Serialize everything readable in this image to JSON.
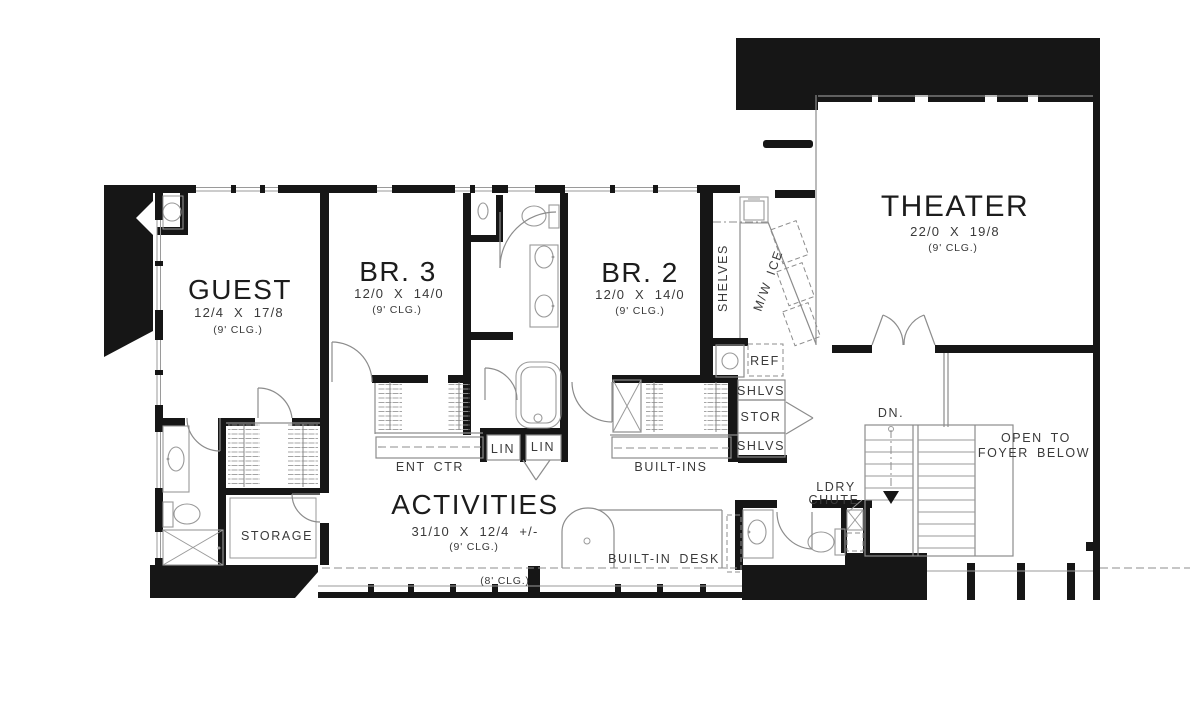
{
  "plan": {
    "rooms": [
      {
        "name": "GUEST",
        "dims": "12/4 X 17/8",
        "clg": "(9' CLG.)"
      },
      {
        "name": "BR. 3",
        "dims": "12/0 X 14/0",
        "clg": "(9' CLG.)"
      },
      {
        "name": "BR. 2",
        "dims": "12/0 X 14/0",
        "clg": "(9' CLG.)"
      },
      {
        "name": "THEATER",
        "dims": "22/0 X 19/8",
        "clg": "(9' CLG.)"
      },
      {
        "name": "ACTIVITIES",
        "dims": "31/10 X 12/4 +/-",
        "clg": "(9' CLG.)"
      }
    ],
    "labels": {
      "shelves": "SHELVES",
      "mw_ice": "M/W ICE",
      "ref": "REF",
      "shlvs_upper": "SHLVS",
      "stor": "STOR",
      "shlvs_lower": "SHLVS",
      "lin_left": "LIN",
      "lin_right": "LIN",
      "ent_ctr": "ENT CTR",
      "built_ins": "BUILT-INS",
      "storage": "STORAGE",
      "built_in_desk": "BUILT-IN DESK",
      "ldry": "LDRY",
      "chute": "CHUTE",
      "dn": "DN.",
      "open_to": "OPEN TO",
      "foyer_below": "FOYER BELOW",
      "clg_8": "(8' CLG.)"
    },
    "colors": {
      "wall": "#161616",
      "line": "#8c8c8c",
      "bg": "#ffffff"
    }
  }
}
